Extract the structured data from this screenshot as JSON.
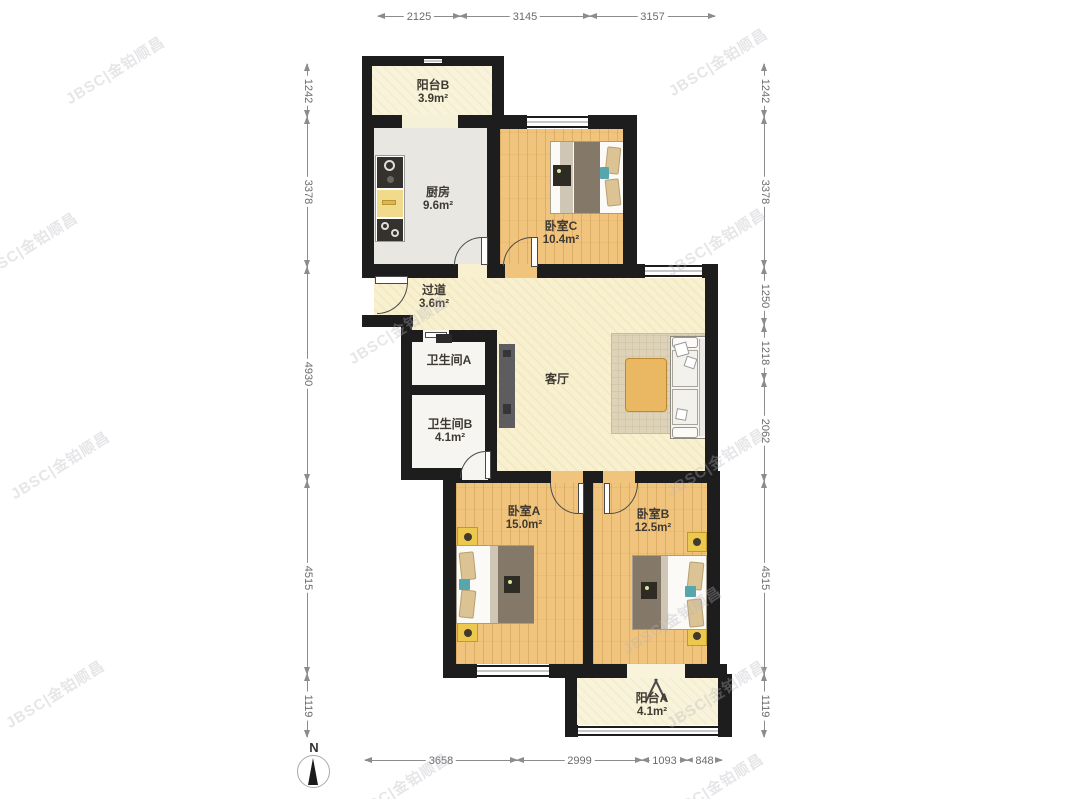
{
  "compass": {
    "label": "N"
  },
  "watermark": {
    "text": "JBSC|金铂顺昌",
    "positions": [
      [
        115,
        70
      ],
      [
        718,
        62
      ],
      [
        28,
        246
      ],
      [
        716,
        242
      ],
      [
        398,
        330
      ],
      [
        60,
        465
      ],
      [
        716,
        462
      ],
      [
        672,
        620
      ],
      [
        55,
        694
      ],
      [
        716,
        694
      ],
      [
        400,
        787
      ],
      [
        714,
        787
      ]
    ]
  },
  "rooms": [
    {
      "id": "balcony-b",
      "name": "阳台B",
      "area": "3.9m²",
      "label_x": 433,
      "label_y": 78
    },
    {
      "id": "kitchen",
      "name": "厨房",
      "area": "9.6m²",
      "label_x": 438,
      "label_y": 185
    },
    {
      "id": "bedroom-c",
      "name": "卧室C",
      "area": "10.4m²",
      "label_x": 561,
      "label_y": 219
    },
    {
      "id": "hallway",
      "name": "过道",
      "area": "3.6m²",
      "label_x": 434,
      "label_y": 283
    },
    {
      "id": "bathroom-a",
      "name": "卫生间A",
      "area": "",
      "label_x": 449,
      "label_y": 353
    },
    {
      "id": "bathroom-b",
      "name": "卫生间B",
      "area": "4.1m²",
      "label_x": 450,
      "label_y": 417
    },
    {
      "id": "living-room",
      "name": "客厅",
      "area": "",
      "label_x": 557,
      "label_y": 372
    },
    {
      "id": "bedroom-a",
      "name": "卧室A",
      "area": "15.0m²",
      "label_x": 524,
      "label_y": 504
    },
    {
      "id": "bedroom-b",
      "name": "卧室B",
      "area": "12.5m²",
      "label_x": 653,
      "label_y": 507
    },
    {
      "id": "balcony-a",
      "name": "阳台A",
      "area": "4.1m²",
      "label_x": 652,
      "label_y": 691
    }
  ],
  "dimensions": [
    {
      "dir": "h",
      "at": 16,
      "from": 378,
      "to": 460,
      "label": "2125"
    },
    {
      "dir": "h",
      "at": 16,
      "from": 460,
      "to": 590,
      "label": "3145"
    },
    {
      "dir": "h",
      "at": 16,
      "from": 590,
      "to": 715,
      "label": "3157"
    },
    {
      "dir": "h",
      "at": 760,
      "from": 365,
      "to": 517,
      "label": "3658"
    },
    {
      "dir": "h",
      "at": 760,
      "from": 517,
      "to": 642,
      "label": "2999"
    },
    {
      "dir": "h",
      "at": 760,
      "from": 642,
      "to": 687,
      "label": "1093"
    },
    {
      "dir": "h",
      "at": 760,
      "from": 687,
      "to": 722,
      "label": "848"
    },
    {
      "dir": "v",
      "at": 307,
      "from": 64,
      "to": 117,
      "label": "1242"
    },
    {
      "dir": "v",
      "at": 307,
      "from": 117,
      "to": 267,
      "label": "3378"
    },
    {
      "dir": "v",
      "at": 307,
      "from": 267,
      "to": 481,
      "label": "4930"
    },
    {
      "dir": "v",
      "at": 307,
      "from": 481,
      "to": 674,
      "label": "4515"
    },
    {
      "dir": "v",
      "at": 307,
      "from": 674,
      "to": 737,
      "label": "1119"
    },
    {
      "dir": "v",
      "at": 764,
      "from": 64,
      "to": 117,
      "label": "1242"
    },
    {
      "dir": "v",
      "at": 764,
      "from": 117,
      "to": 267,
      "label": "3378"
    },
    {
      "dir": "v",
      "at": 764,
      "from": 267,
      "to": 325,
      "label": "1250"
    },
    {
      "dir": "v",
      "at": 764,
      "from": 325,
      "to": 380,
      "label": "1218"
    },
    {
      "dir": "v",
      "at": 764,
      "from": 380,
      "to": 481,
      "label": "2062"
    },
    {
      "dir": "v",
      "at": 764,
      "from": 481,
      "to": 674,
      "label": "4515"
    },
    {
      "dir": "v",
      "at": 764,
      "from": 674,
      "to": 737,
      "label": "1119"
    }
  ]
}
